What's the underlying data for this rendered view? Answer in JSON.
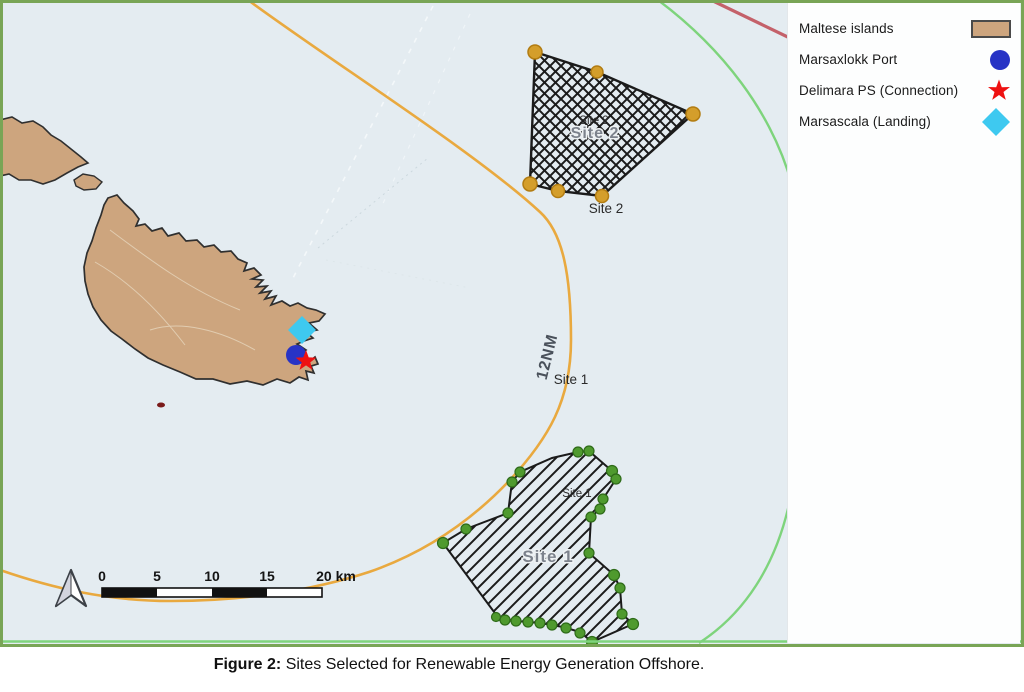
{
  "figure": {
    "caption_prefix": "Figure 2:",
    "caption_body": " Sites Selected for Renewable Energy Generation Offshore."
  },
  "legend": {
    "items": [
      {
        "label": "Maltese islands",
        "symbol": "land-area-swatch",
        "color": "#cda57e"
      },
      {
        "label": "Marsaxlokk Port",
        "symbol": "port-circle-marker",
        "color": "#2733c5"
      },
      {
        "label": "Delimara PS (Connection)",
        "symbol": "connection-star-marker",
        "color": "#ee1111"
      },
      {
        "label": "Marsascala (Landing)",
        "symbol": "landing-diamond-marker",
        "color": "#3ec9f0"
      }
    ]
  },
  "map": {
    "labels": {
      "territorial_line": "12NM",
      "site1_point": "Site 1",
      "site1_area_small": "Site 1",
      "site1_area_large": "Site 1",
      "site2_area_small": "Site 2",
      "site2_area_large": "Site 2",
      "site2_point": "Site 2"
    },
    "scale_bar": {
      "ticks": [
        "0",
        "5",
        "10",
        "15"
      ],
      "end_label": "20 km"
    },
    "colors": {
      "sea": "#e4ecf1",
      "land": "#cda57e",
      "coastline": "#2f2f2f",
      "territorial_line": "#e9a93f",
      "boundary_green": "#7ed47c",
      "boundary_red": "#c4616a",
      "site_outline": "#1b1b1b",
      "site1_vertex": "#4f9a2e",
      "site2_vertex": "#d49e2b",
      "frame": "#79a556"
    }
  }
}
